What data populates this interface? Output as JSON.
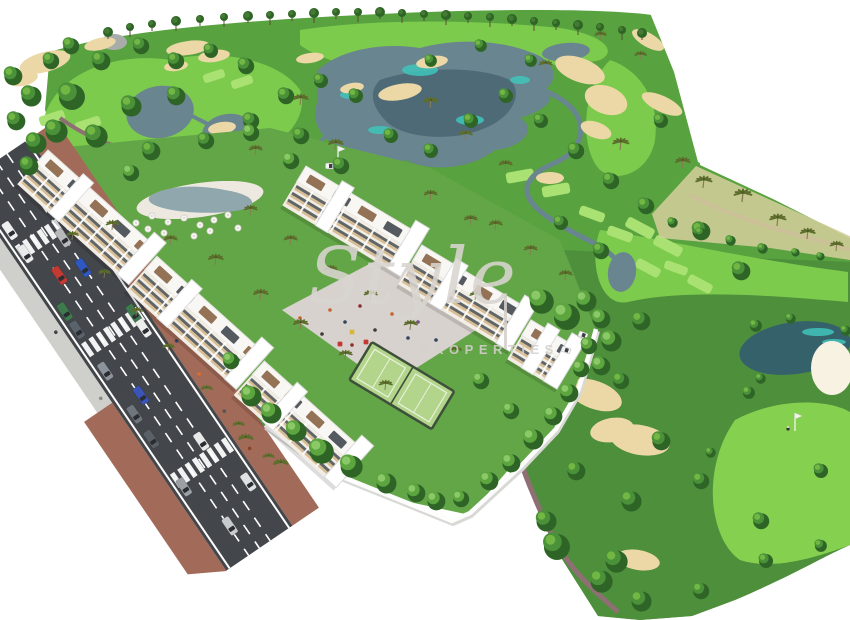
{
  "watermark": {
    "brand": "Style",
    "word": "PROPERTIES",
    "divider": "|"
  },
  "palette": {
    "background": "#ffffff",
    "rough": "#58a23f",
    "rough_dark": "#4e8f3c",
    "fairway": "#7dcb4d",
    "fairway_light": "#93d963",
    "green_bright": "#85d14f",
    "tee_light": "#a9e173",
    "tree_dark": "#2e6527",
    "tree_mid": "#4a9139",
    "tree_light": "#74b845",
    "garden_tree_mid": "#5da53f",
    "garden_tree_light": "#8cc96a",
    "palm": "#5d6e2c",
    "palm_trunk": "#8a7a55",
    "water": "#69858f",
    "water_dark": "#4e6a77",
    "water_teal": "#3fc4bb",
    "pond_dark": "#35616b",
    "sand": "#ecd8a7",
    "sand_bright": "#f8f2e2",
    "scrub": "#d6cf9e",
    "asphalt": "#43464b",
    "marking": "#ffffff",
    "sidewalk": "#cfd0cb",
    "brick": "#a26a58",
    "path": "#8e6f74",
    "wall": "#fdfdfd",
    "roof": "#f8f7f4",
    "roof_edge": "#e4e2de",
    "facade": "#f2ede4",
    "balcony_cream": "#d8bd93",
    "window_dark": "#474c52",
    "pergola": "#8a6648",
    "shadow": "#b9b9bd",
    "pool": "#8fa7ad",
    "deck": "#eee9e0",
    "lawn": "#6faf4e",
    "garden": "#63a648",
    "plaza": "#d8d2ce",
    "court": "#b2d48b",
    "court_line": "#e9f2da",
    "fence": "#3e4f3a",
    "rock": "#a8adaa",
    "cart_white": "#f4f4f1",
    "flag_white": "#f2f2f0"
  },
  "scene": {
    "label": "Aerial 3D render of golf-resort apartment development",
    "horizon_trees": [
      [
        108,
        33
      ],
      [
        130,
        28
      ],
      [
        152,
        25
      ],
      [
        176,
        22
      ],
      [
        200,
        20
      ],
      [
        224,
        18
      ],
      [
        248,
        17
      ],
      [
        270,
        16
      ],
      [
        292,
        15
      ],
      [
        314,
        14
      ],
      [
        336,
        13
      ],
      [
        358,
        13
      ],
      [
        380,
        13
      ],
      [
        402,
        14
      ],
      [
        424,
        15
      ],
      [
        446,
        16
      ],
      [
        468,
        17
      ],
      [
        490,
        18
      ],
      [
        512,
        20
      ],
      [
        534,
        22
      ],
      [
        556,
        24
      ],
      [
        578,
        26
      ],
      [
        600,
        28
      ],
      [
        622,
        31
      ],
      [
        642,
        34
      ]
    ],
    "course_trees": [
      [
        12,
        75,
        9
      ],
      [
        30,
        95,
        10
      ],
      [
        15,
        120,
        9
      ],
      [
        35,
        142,
        10
      ],
      [
        28,
        165,
        9
      ],
      [
        50,
        60,
        8
      ],
      [
        70,
        45,
        8
      ],
      [
        70,
        95,
        13
      ],
      [
        55,
        130,
        11
      ],
      [
        100,
        60,
        9
      ],
      [
        140,
        45,
        8
      ],
      [
        175,
        60,
        8
      ],
      [
        210,
        50,
        7
      ],
      [
        245,
        65,
        8
      ],
      [
        175,
        95,
        9
      ],
      [
        130,
        105,
        10
      ],
      [
        95,
        135,
        11
      ],
      [
        150,
        150,
        9
      ],
      [
        205,
        140,
        8
      ],
      [
        250,
        120,
        8
      ],
      [
        285,
        95,
        8
      ],
      [
        320,
        80,
        7
      ],
      [
        355,
        95,
        7
      ],
      [
        300,
        135,
        8
      ],
      [
        340,
        165,
        8
      ],
      [
        390,
        135,
        7
      ],
      [
        430,
        150,
        7
      ],
      [
        470,
        120,
        7
      ],
      [
        505,
        95,
        7
      ],
      [
        540,
        120,
        7
      ],
      [
        575,
        150,
        8
      ],
      [
        610,
        180,
        8
      ],
      [
        645,
        205,
        8
      ],
      [
        430,
        60,
        6
      ],
      [
        480,
        45,
        6
      ],
      [
        530,
        60,
        6
      ],
      [
        660,
        120,
        7
      ],
      [
        700,
        230,
        9
      ],
      [
        740,
        270,
        9
      ],
      [
        640,
        320,
        9
      ],
      [
        620,
        380,
        8
      ],
      [
        660,
        440,
        9
      ],
      [
        630,
        500,
        10
      ],
      [
        615,
        560,
        11
      ],
      [
        700,
        480,
        8
      ],
      [
        760,
        520,
        8
      ],
      [
        820,
        470,
        7
      ],
      [
        575,
        470,
        9
      ],
      [
        545,
        520,
        10
      ],
      [
        555,
        545,
        13
      ],
      [
        600,
        580,
        11
      ],
      [
        640,
        600,
        10
      ],
      [
        700,
        590,
        8
      ],
      [
        748,
        392,
        6
      ],
      [
        710,
        452,
        5
      ],
      [
        765,
        560,
        7
      ],
      [
        820,
        545,
        6
      ],
      [
        755,
        325,
        6
      ],
      [
        790,
        318,
        5
      ],
      [
        845,
        330,
        5
      ],
      [
        760,
        378,
        5
      ],
      [
        672,
        222,
        5
      ],
      [
        700,
        232,
        5
      ],
      [
        730,
        240,
        5
      ],
      [
        762,
        248,
        5
      ],
      [
        795,
        252,
        4
      ],
      [
        820,
        256,
        4
      ],
      [
        600,
        250,
        8
      ],
      [
        560,
        222,
        7
      ]
    ],
    "garden_trees": [
      [
        295,
        430,
        10
      ],
      [
        320,
        450,
        12
      ],
      [
        350,
        465,
        11
      ],
      [
        385,
        482,
        10
      ],
      [
        415,
        492,
        9
      ],
      [
        250,
        395,
        10
      ],
      [
        270,
        412,
        10
      ],
      [
        435,
        500,
        9
      ],
      [
        460,
        498,
        8
      ],
      [
        488,
        480,
        9
      ],
      [
        510,
        462,
        9
      ],
      [
        532,
        438,
        10
      ],
      [
        552,
        415,
        9
      ],
      [
        568,
        392,
        9
      ],
      [
        580,
        368,
        8
      ],
      [
        588,
        345,
        8
      ],
      [
        540,
        300,
        12
      ],
      [
        565,
        315,
        13
      ],
      [
        585,
        300,
        10
      ],
      [
        600,
        318,
        9
      ],
      [
        610,
        340,
        10
      ],
      [
        600,
        365,
        9
      ],
      [
        480,
        380,
        8
      ],
      [
        510,
        410,
        8
      ],
      [
        230,
        360,
        8
      ],
      [
        130,
        172,
        8
      ],
      [
        250,
        132,
        8
      ],
      [
        290,
        160,
        8
      ]
    ],
    "palms": [
      [
        300,
        105,
        1
      ],
      [
        335,
        150,
        1
      ],
      [
        430,
        108,
        1
      ],
      [
        465,
        140,
        0.9
      ],
      [
        505,
        170,
        0.9
      ],
      [
        545,
        70,
        0.9
      ],
      [
        620,
        150,
        1.1
      ],
      [
        682,
        168,
        1
      ],
      [
        703,
        188,
        1.1
      ],
      [
        742,
        202,
        1.2
      ],
      [
        777,
        226,
        1.1
      ],
      [
        807,
        239,
        1
      ],
      [
        836,
        251,
        0.9
      ],
      [
        112,
        230,
        0.9
      ],
      [
        170,
        245,
        0.9
      ],
      [
        215,
        265,
        1
      ],
      [
        260,
        300,
        1
      ],
      [
        300,
        330,
        1
      ],
      [
        345,
        360,
        0.9
      ],
      [
        385,
        390,
        0.9
      ],
      [
        250,
        215,
        0.9
      ],
      [
        290,
        245,
        0.9
      ],
      [
        330,
        275,
        0.9
      ],
      [
        370,
        300,
        0.9
      ],
      [
        410,
        330,
        0.9
      ],
      [
        455,
        355,
        0.8
      ],
      [
        495,
        230,
        0.9
      ],
      [
        530,
        255,
        0.9
      ],
      [
        565,
        280,
        0.9
      ],
      [
        430,
        200,
        0.9
      ],
      [
        470,
        225,
        0.9
      ],
      [
        255,
        155,
        0.9
      ],
      [
        640,
        60,
        0.8
      ],
      [
        600,
        40,
        0.8
      ],
      [
        245,
        445,
        1
      ],
      [
        280,
        470,
        1
      ],
      [
        475,
        300,
        0.8
      ],
      [
        72,
        240,
        0.8
      ],
      [
        104,
        278,
        0.8
      ],
      [
        136,
        316,
        0.8
      ],
      [
        168,
        352,
        0.8
      ],
      [
        206,
        394,
        0.8
      ],
      [
        238,
        430,
        0.8
      ],
      [
        268,
        462,
        0.8
      ]
    ],
    "bunkers": [
      [
        45,
        62,
        26,
        10,
        -15
      ],
      [
        22,
        78,
        16,
        8,
        -10
      ],
      [
        100,
        44,
        16,
        6,
        -12
      ],
      [
        188,
        48,
        22,
        7,
        -8
      ],
      [
        214,
        56,
        16,
        6,
        -8
      ],
      [
        176,
        66,
        12,
        5,
        -8
      ],
      [
        310,
        58,
        14,
        5,
        -8
      ],
      [
        432,
        62,
        16,
        6,
        -8
      ],
      [
        400,
        92,
        22,
        8,
        -10
      ],
      [
        352,
        88,
        12,
        5,
        -10
      ],
      [
        580,
        70,
        26,
        12,
        20
      ],
      [
        606,
        100,
        22,
        14,
        20
      ],
      [
        596,
        130,
        16,
        8,
        20
      ],
      [
        648,
        40,
        18,
        7,
        30
      ],
      [
        662,
        104,
        22,
        8,
        25
      ],
      [
        550,
        178,
        14,
        6,
        0
      ],
      [
        595,
        395,
        28,
        14,
        20
      ],
      [
        640,
        440,
        30,
        15,
        10
      ],
      [
        612,
        430,
        22,
        12,
        -10
      ],
      [
        638,
        560,
        22,
        10,
        10
      ],
      [
        222,
        128,
        14,
        6,
        -8
      ]
    ],
    "bright_bunker": [
      832,
      368,
      21,
      27
    ],
    "tees": [
      [
        52,
        118,
        26,
        10,
        -18
      ],
      [
        88,
        124,
        26,
        10,
        -18
      ],
      [
        214,
        76,
        22,
        9,
        -18
      ],
      [
        242,
        82,
        22,
        9,
        -18
      ],
      [
        640,
        228,
        30,
        11,
        28
      ],
      [
        668,
        246,
        30,
        11,
        28
      ],
      [
        648,
        268,
        26,
        10,
        28
      ],
      [
        700,
        284,
        26,
        10,
        28
      ],
      [
        520,
        176,
        28,
        11,
        -10
      ],
      [
        556,
        190,
        28,
        11,
        -10
      ],
      [
        592,
        214,
        26,
        10,
        20
      ],
      [
        620,
        234,
        26,
        10,
        20
      ],
      [
        676,
        268,
        24,
        9,
        20
      ]
    ],
    "teal_patches": [
      [
        420,
        70,
        18,
        6
      ],
      [
        470,
        120,
        14,
        5
      ],
      [
        380,
        130,
        12,
        4
      ],
      [
        520,
        80,
        10,
        4
      ],
      [
        350,
        95,
        10,
        4
      ],
      [
        818,
        332,
        16,
        4
      ],
      [
        834,
        342,
        12,
        3
      ]
    ],
    "ponds": [
      [
        160,
        112,
        34,
        26,
        -10
      ],
      [
        228,
        132,
        26,
        18,
        -8
      ],
      [
        262,
        160,
        16,
        9,
        0
      ],
      [
        566,
        52,
        24,
        9,
        -5
      ],
      [
        622,
        272,
        14,
        20,
        8
      ],
      [
        795,
        348,
        56,
        26,
        -8
      ]
    ],
    "parasols": [
      [
        152,
        216
      ],
      [
        168,
        222
      ],
      [
        184,
        218
      ],
      [
        200,
        225
      ],
      [
        214,
        220
      ],
      [
        148,
        229
      ],
      [
        228,
        215
      ],
      [
        164,
        233
      ],
      [
        194,
        236
      ],
      [
        210,
        231
      ],
      [
        136,
        223
      ],
      [
        122,
        226
      ],
      [
        108,
        228
      ],
      [
        92,
        226
      ],
      [
        78,
        229
      ],
      [
        238,
        228
      ]
    ],
    "plaza_people": [
      [
        330,
        310,
        "#c9622a"
      ],
      [
        345,
        322,
        "#31455f"
      ],
      [
        360,
        306,
        "#8a2f2f"
      ],
      [
        375,
        330,
        "#3c3c3c"
      ],
      [
        392,
        314,
        "#c9622a"
      ],
      [
        408,
        338,
        "#31455f"
      ],
      [
        352,
        345,
        "#8a2f2f"
      ],
      [
        322,
        334,
        "#3c3c3c"
      ],
      [
        418,
        322,
        "#7a4a8c"
      ],
      [
        300,
        318,
        "#c9622a"
      ],
      [
        436,
        340,
        "#31455f"
      ]
    ],
    "play_equipment": [
      [
        352,
        332,
        "#d8b83a"
      ],
      [
        366,
        342,
        "#c23a31"
      ],
      [
        380,
        350,
        "#2e6fc0"
      ],
      [
        394,
        358,
        "#49953a"
      ],
      [
        340,
        344,
        "#c23a31"
      ]
    ],
    "flags": [
      [
        795,
        413
      ],
      [
        338,
        146
      ]
    ],
    "golfer": [
      788,
      429
    ],
    "carts": [
      [
        566,
        350,
        20
      ],
      [
        330,
        166,
        0
      ],
      [
        583,
        335,
        20
      ]
    ],
    "buildings": {
      "left_row": {
        "x": 48,
        "y": 150,
        "angle": 42,
        "blocks": [
          [
            0,
            0,
            150
          ],
          [
            152,
            6,
            148
          ],
          [
            302,
            12,
            138
          ]
        ]
      },
      "right_row": {
        "x": 306,
        "y": 166,
        "angle": 31,
        "blocks": [
          [
            0,
            0,
            138
          ],
          [
            140,
            8,
            130
          ],
          [
            272,
            16,
            58
          ]
        ]
      }
    },
    "road": {
      "zebras": [
        54,
        172,
        330
      ],
      "cars": [
        {
          "t": 30,
          "l": 1,
          "c": "#eef0f0"
        },
        {
          "t": 58,
          "l": 1,
          "c": "#e9ebeb"
        },
        {
          "t": 66,
          "l": -0.4,
          "c": "#b7babd"
        },
        {
          "t": 95,
          "l": 0.4,
          "c": "#c23a31"
        },
        {
          "t": 102,
          "l": -0.4,
          "c": "#2e57c0"
        },
        {
          "t": 128,
          "l": 1,
          "c": "#3f7a4e"
        },
        {
          "t": 150,
          "l": 1,
          "c": "#5a636b"
        },
        {
          "t": 168,
          "l": -1,
          "c": "#3f7a4e"
        },
        {
          "t": 186,
          "l": -1,
          "c": "#eceeee"
        },
        {
          "t": 200,
          "l": 1,
          "c": "#8d939a"
        },
        {
          "t": 240,
          "l": 0.4,
          "c": "#3a54b8"
        },
        {
          "t": 252,
          "l": 1,
          "c": "#70767e"
        },
        {
          "t": 282,
          "l": 1,
          "c": "#596067"
        },
        {
          "t": 312,
          "l": -0.4,
          "c": "#e8eaea"
        },
        {
          "t": 340,
          "l": 1,
          "c": "#9aa0a5"
        },
        {
          "t": 372,
          "l": -1,
          "c": "#dfe2e2"
        },
        {
          "t": 398,
          "l": 0.4,
          "c": "#c8cbcd"
        }
      ],
      "pedestrians_right": [
        55,
        90,
        130,
        170,
        215,
        255,
        300,
        345
      ],
      "pedestrians_left": [
        140,
        220
      ],
      "ped_colors": [
        "#d96f2a",
        "#444444",
        "#8a8a8a",
        "#aa3333",
        "#334466",
        "#d96f2a",
        "#555555",
        "#884422"
      ]
    }
  }
}
